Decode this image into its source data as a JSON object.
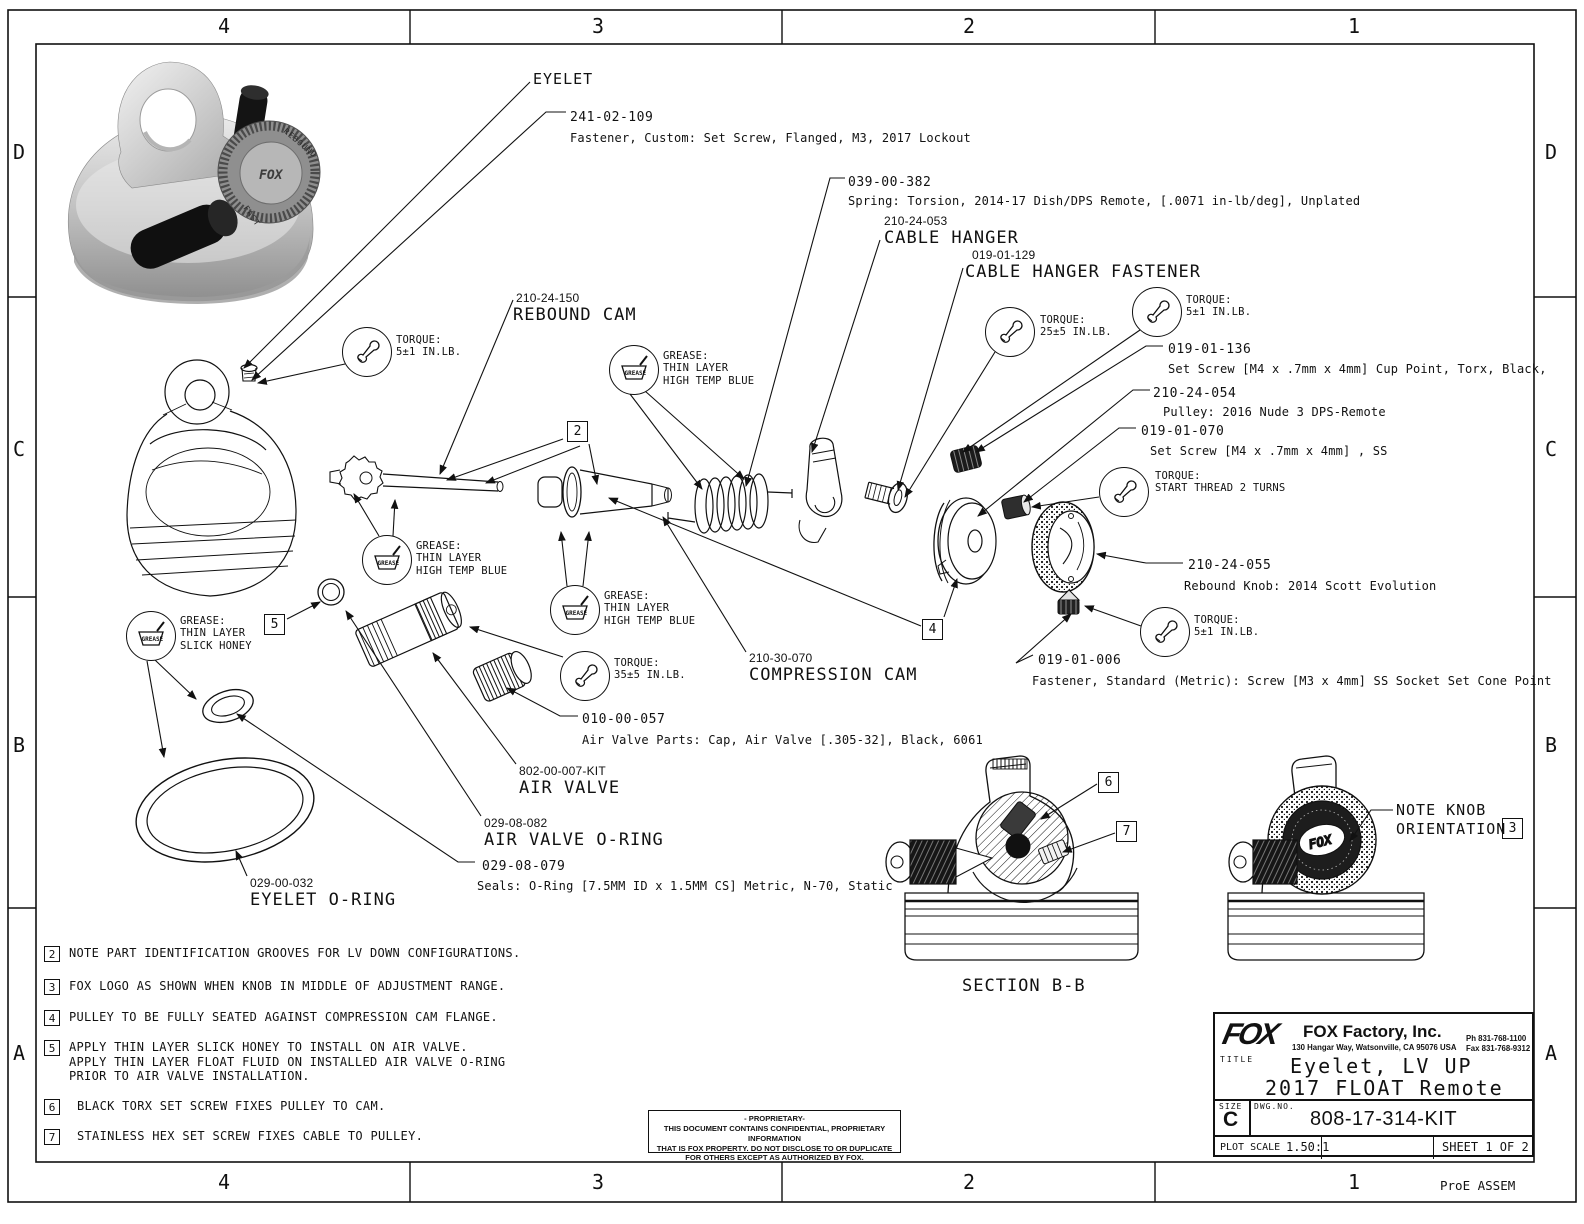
{
  "zones": {
    "cols": [
      "4",
      "3",
      "2",
      "1"
    ],
    "rows": [
      "D",
      "C",
      "B",
      "A"
    ]
  },
  "footer": {
    "proe": "ProE ASSEM"
  },
  "callouts": {
    "eyelet": {
      "name": "EYELET"
    },
    "fastener_241": {
      "pn": "241-02-109",
      "desc": "Fastener, Custom: Set Screw, Flanged, M3, 2017 Lockout"
    },
    "spring_039": {
      "pn": "039-00-382",
      "desc": "Spring: Torsion, 2014-17 Dish/DPS Remote, [.0071 in-lb/deg], Unplated"
    },
    "cable_hanger": {
      "pn": "210-24-053",
      "name": "CABLE HANGER"
    },
    "cable_hanger_fastener": {
      "pn": "019-01-129",
      "name": "CABLE HANGER FASTENER"
    },
    "set_screw_136": {
      "pn": "019-01-136",
      "desc": "Set Screw [M4 x .7mm x 4mm] Cup Point, Torx, Black,"
    },
    "pulley": {
      "pn": "210-24-054",
      "desc": "Pulley: 2016 Nude 3 DPS-Remote"
    },
    "set_screw_070": {
      "pn": "019-01-070",
      "desc": "Set Screw [M4 x .7mm x 4mm] , SS"
    },
    "rebound_knob": {
      "pn": "210-24-055",
      "desc": "Rebound Knob: 2014 Scott Evolution"
    },
    "fastener_006": {
      "pn": "019-01-006",
      "desc": "Fastener, Standard (Metric): Screw [M3 x 4mm] SS Socket Set Cone Point"
    },
    "rebound_cam": {
      "pn": "210-24-150",
      "name": "REBOUND CAM"
    },
    "compression_cam": {
      "pn": "210-30-070",
      "name": "COMPRESSION CAM"
    },
    "air_valve_cap": {
      "pn": "010-00-057",
      "desc": "Air Valve Parts: Cap, Air Valve [.305-32], Black, 6061"
    },
    "air_valve": {
      "pn": "802-00-007-KIT",
      "name": "AIR VALVE"
    },
    "air_valve_oring": {
      "pn": "029-08-082",
      "name": "AIR VALVE O-RING"
    },
    "seal_oring": {
      "pn": "029-08-079",
      "desc": "Seals: O-Ring [7.5MM ID x 1.5MM CS] Metric, N-70, Static"
    },
    "eyelet_oring": {
      "pn": "029-00-032",
      "name": "EYELET O-RING"
    }
  },
  "torque_notes": {
    "label": "TORQUE:",
    "t_rebound_screw": "5±1 IN.LB.",
    "t_cable_hanger": "25±5 IN.LB.",
    "t_set_screw_136": "5±1 IN.LB.",
    "t_start_thread": "START THREAD 2 TURNS",
    "t_cone_screw": "5±1 IN.LB.",
    "t_air_valve": "35±5 IN.LB."
  },
  "grease_notes": {
    "label": "GREASE:",
    "icon_text": "GREASE",
    "thin_layer": "THIN LAYER",
    "high_temp_blue": "HIGH TEMP BLUE",
    "slick_honey": "SLICK HONEY"
  },
  "flags": {
    "f2": "2",
    "f3": "3",
    "f4": "4",
    "f5": "5",
    "f6": "6",
    "f7": "7"
  },
  "notes": [
    {
      "num": "2",
      "lines": [
        "NOTE PART IDENTIFICATION GROOVES FOR LV DOWN CONFIGURATIONS."
      ]
    },
    {
      "num": "3",
      "lines": [
        "FOX LOGO AS SHOWN WHEN KNOB IN MIDDLE OF ADJUSTMENT RANGE."
      ]
    },
    {
      "num": "4",
      "lines": [
        "PULLEY TO BE FULLY SEATED AGAINST COMPRESSION CAM FLANGE."
      ]
    },
    {
      "num": "5",
      "lines": [
        "APPLY THIN LAYER SLICK HONEY TO INSTALL ON AIR VALVE.",
        "APPLY THIN LAYER FLOAT FLUID ON INSTALLED AIR VALVE O-RING",
        "PRIOR TO AIR VALVE INSTALLATION."
      ]
    },
    {
      "num": "6",
      "lines": [
        "BLACK TORX SET SCREW FIXES PULLEY TO CAM."
      ]
    },
    {
      "num": "7",
      "lines": [
        "STAINLESS HEX SET SCREW FIXES CABLE TO PULLEY."
      ]
    }
  ],
  "views": {
    "section_label": "SECTION  B-B",
    "knob_note_line1": "NOTE KNOB",
    "knob_note_line2": "ORIENTATION",
    "knob_note_ref": "3",
    "knob_logo": "FOX"
  },
  "render": {
    "knob_text_rebound": "REBOUND",
    "knob_text_fast": "FAST",
    "knob_text_fox": "FOX"
  },
  "proprietary": {
    "l1": "- PROPRIETARY-",
    "l2": "THIS DOCUMENT CONTAINS CONFIDENTIAL, PROPRIETARY INFORMATION",
    "l3": "THAT IS FOX PROPERTY.  DO NOT DISCLOSE TO OR DUPLICATE",
    "l4": "FOR OTHERS EXCEPT AS AUTHORIZED BY FOX."
  },
  "title_block": {
    "logo": "FOX",
    "company": "FOX Factory, Inc.",
    "address": "130 Hangar Way, Watsonville, CA 95076 USA",
    "phone": "Ph 831-768-1100",
    "fax": "Fax 831-768-9312",
    "title_label": "TITLE",
    "title_line1": "Eyelet, LV UP",
    "title_line2": "2017 FLOAT Remote",
    "size_label": "SIZE",
    "size": "C",
    "dwg_label": "DWG.NO.",
    "dwg_no": "808-17-314-KIT",
    "plot_scale_label": "PLOT SCALE",
    "plot_scale": "1.50:1",
    "sheet": "SHEET 1 OF 2"
  }
}
